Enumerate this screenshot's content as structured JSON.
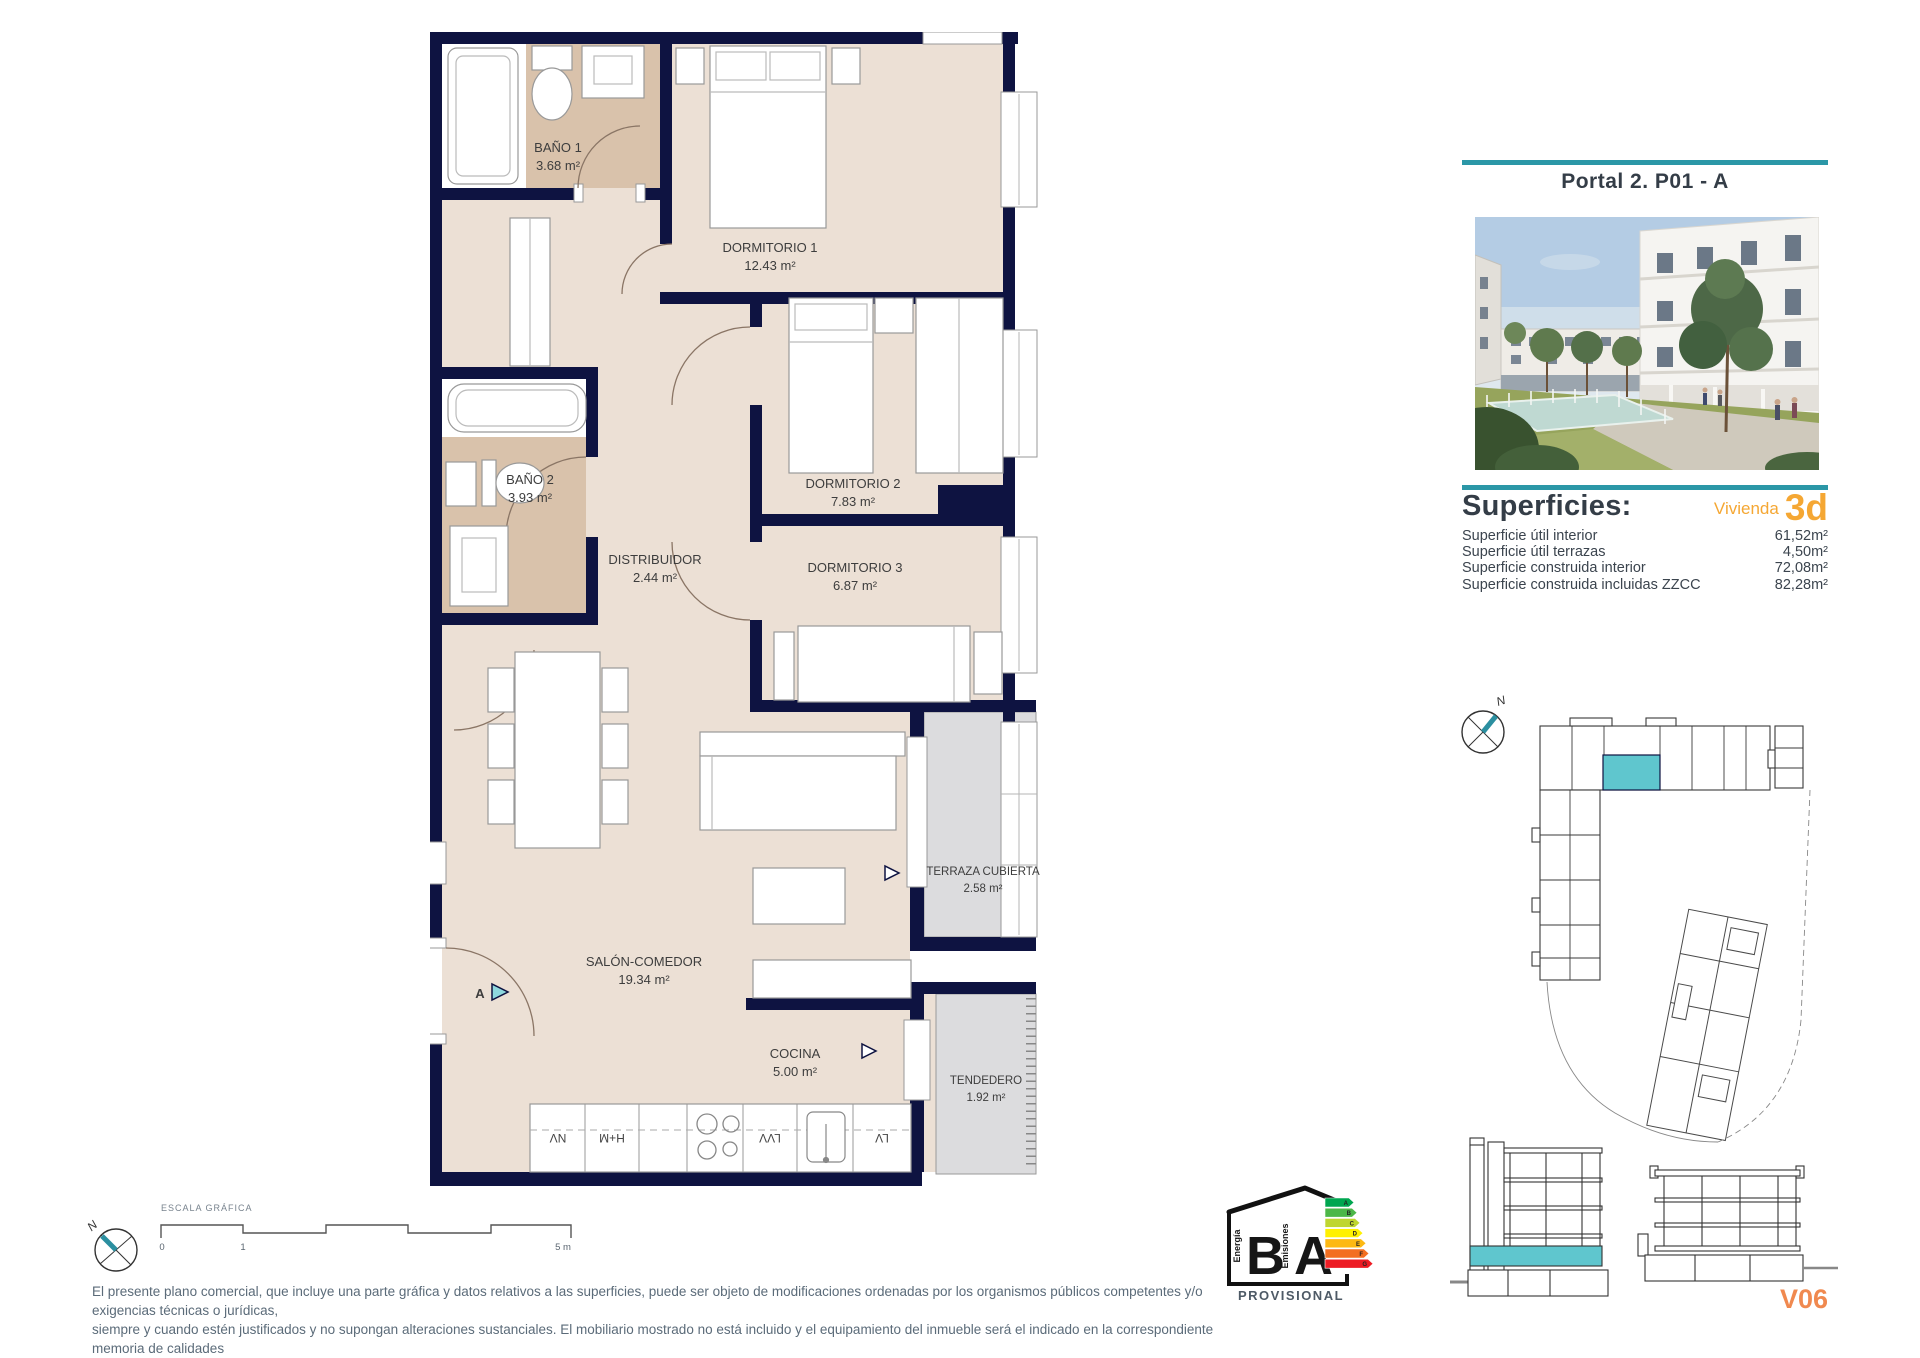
{
  "header": {
    "title": "Portal 2. P01 - A"
  },
  "superficies": {
    "heading": "Superficies:",
    "vivienda_label": "Vivienda",
    "vivienda_code": "3d",
    "rows": [
      {
        "label": "Superficie útil interior",
        "value": "61,52m²"
      },
      {
        "label": "Superficie útil terrazas",
        "value": "4,50m²"
      },
      {
        "label": "Superficie construida interior",
        "value": "72,08m²"
      },
      {
        "label": "Superficie construida incluidas ZZCC",
        "value": "82,28m²"
      }
    ]
  },
  "plan": {
    "rooms": [
      {
        "name": "BAÑO 1",
        "area": "3.68 m²"
      },
      {
        "name": "DORMITORIO 1",
        "area": "12.43 m²"
      },
      {
        "name": "BAÑO 2",
        "area": "3.93 m²"
      },
      {
        "name": "DISTRIBUIDOR",
        "area": "2.44 m²"
      },
      {
        "name": "DORMITORIO 2",
        "area": "7.83 m²"
      },
      {
        "name": "DORMITORIO 3",
        "area": "6.87 m²"
      },
      {
        "name": "SALÓN-COMEDOR",
        "area": "19.34 m²"
      },
      {
        "name": "COCINA",
        "area": "5.00 m²"
      },
      {
        "name": "TERRAZA CUBIERTA",
        "area": "2.58 m²"
      },
      {
        "name": "TENDEDERO",
        "area": "1.92 m²"
      }
    ],
    "entrance_label": "A",
    "kitchen_units": [
      "NV",
      "H+M",
      "LVV",
      "LV"
    ]
  },
  "scale_bar": {
    "label": "ESCALA GRÁFICA",
    "ticks": [
      "0",
      "1",
      "5 m"
    ]
  },
  "compass": {
    "north_label": "N"
  },
  "site_plan": {
    "north_label": "N"
  },
  "energy_badge": {
    "letters": [
      "B",
      "A"
    ],
    "left_caption": "Energía",
    "right_caption": "Emisiones",
    "status": "PROVISIONAL",
    "arrow_letters": [
      "A",
      "B",
      "C",
      "D",
      "E",
      "F",
      "G"
    ],
    "arrow_colors": [
      "#00a650",
      "#4cb748",
      "#bfd630",
      "#fff100",
      "#fdb913",
      "#f36f21",
      "#ed1c24"
    ]
  },
  "plan_code": "V06",
  "disclaimer": {
    "line1": "El presente plano comercial, que incluye una parte gráfica y datos relativos a las superficies, puede ser objeto de modificaciones ordenadas por los organismos públicos competentes y/o exigencias técnicas o jurídicas,",
    "line2": "siempre y cuando estén justificados y no supongan alteraciones sustanciales. El mobiliario mostrado no está incluido y el equipamiento del inmueble será el indicado en la correspondiente memoria de calidades"
  },
  "colors": {
    "wall_navy": "#0e1341",
    "teal_accent": "#2b97a7",
    "teal_fill": "#5fc6ce",
    "floor_beige": "#ece0d5",
    "floor_tan": "#d9c2ab",
    "floor_gray": "#dcdcde",
    "orange": "#f5a733",
    "code_orange": "#f0894f"
  }
}
